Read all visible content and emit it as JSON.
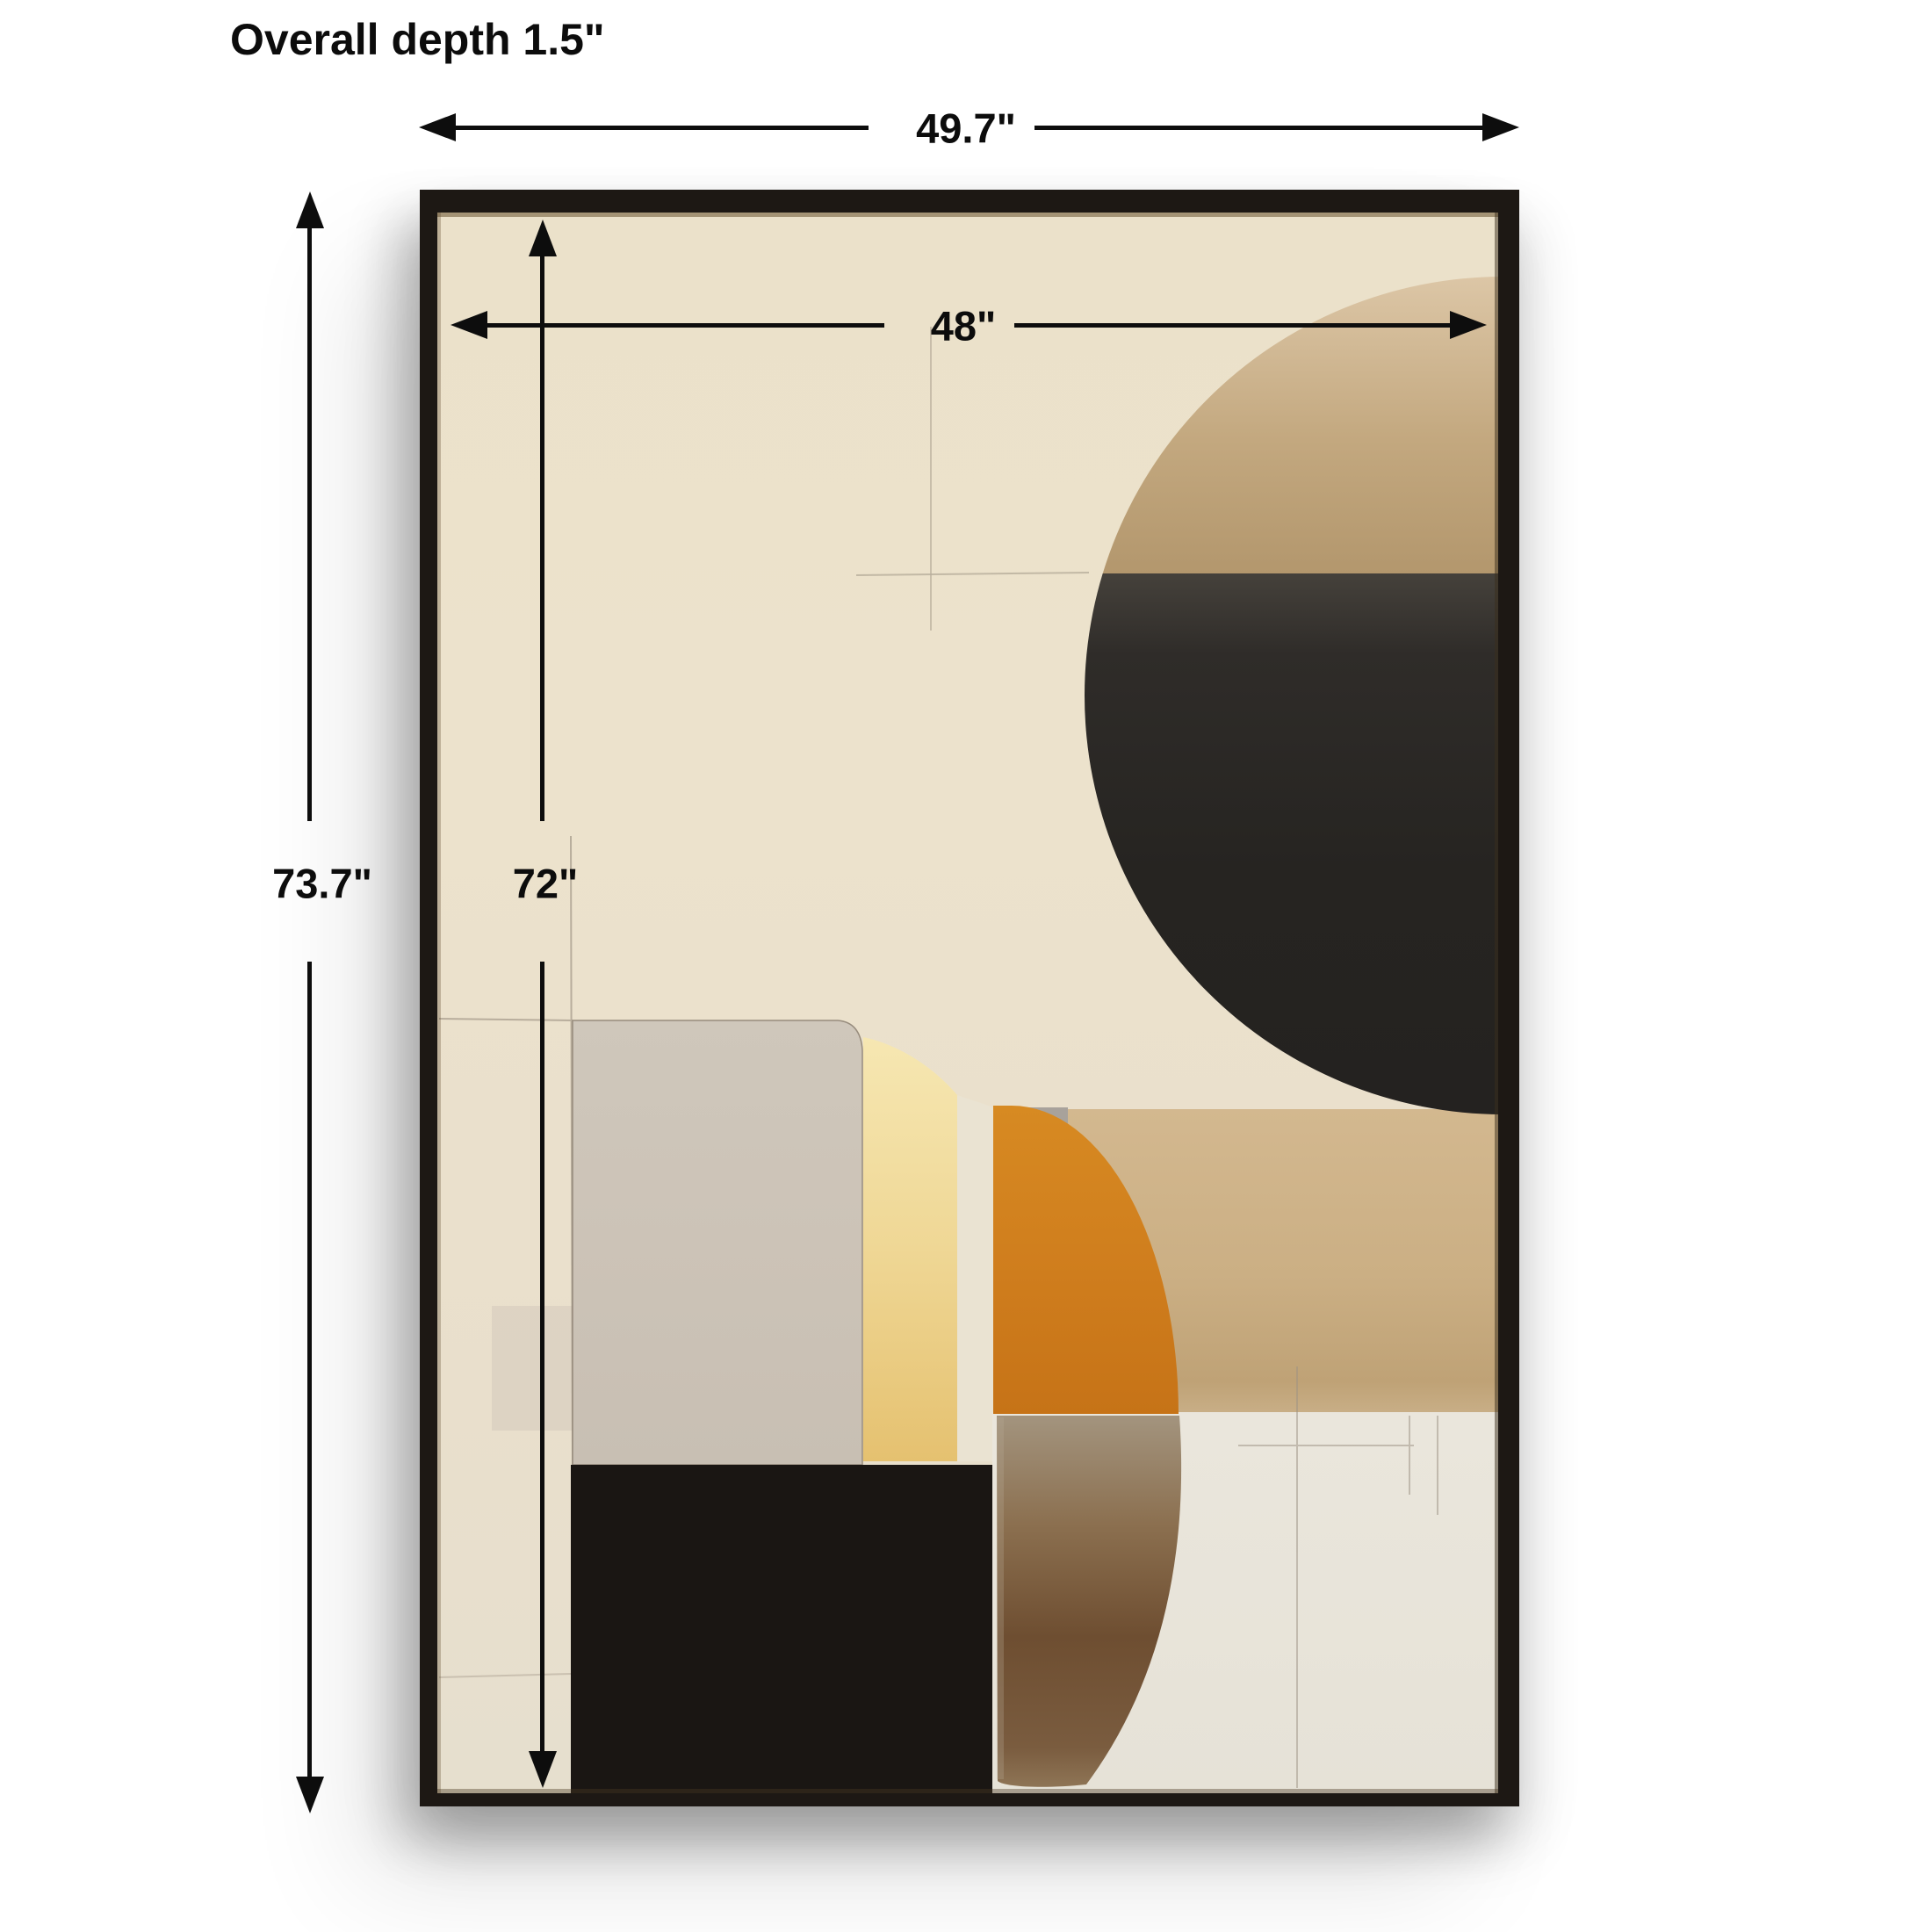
{
  "diagram": {
    "title": "Overall depth 1.5\"",
    "overall_width": "49.7\"",
    "inner_width": "48\"",
    "overall_height": "73.7\"",
    "inner_height": "72\""
  },
  "artwork": {
    "description": "Black-framed abstract canvas with cream ground, tan and charcoal half-circle, greige block, yellow strip, orange quarter shape, tan block, brown tusk shape and black block"
  },
  "colors": {
    "dimension_ink": "#0d0d0d",
    "frame_black": "#1d1814",
    "canvas_cream": "#ece2cb",
    "circle_tan": "#bfa37a",
    "circle_charcoal": "#2b2825",
    "block_greige": "#cbc2b7",
    "strip_yellow": "#eed088",
    "strip_pale": "#eae3d2",
    "wedge_gray": "#a8a29b",
    "block_tan": "#c9ad83",
    "shape_orange": "#cf7d1d",
    "tusk_brown": "#75553a",
    "block_black": "#1a1613",
    "panel_pale": "#e8e4da"
  }
}
